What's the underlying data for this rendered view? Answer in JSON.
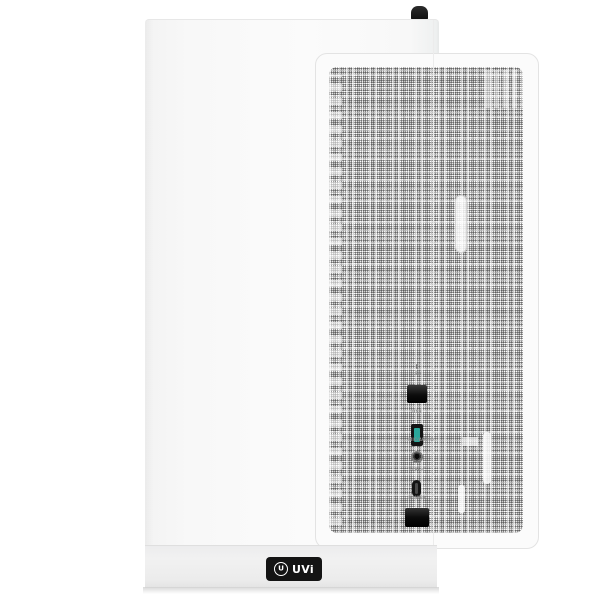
{
  "scene": {
    "type": "product-photo",
    "subject": "White mid-tower PC case, front view with perforated mesh front panel",
    "background_color": "#ffffff",
    "case_color": "#f8f8f8",
    "base_color": "#ececec",
    "mesh_dot_color": "#464646",
    "port_black": "#141414",
    "usb_accent_color": "#2aa79a",
    "label_color": "#8b8b8b"
  },
  "io_panel": {
    "ports": [
      {
        "label": "LED",
        "kind": "button"
      },
      {
        "label": "USB",
        "kind": "usb-a"
      },
      {
        "label": "MIC/AUDIO",
        "kind": "audio-jack"
      },
      {
        "label": "TYPE-C",
        "kind": "usb-c"
      },
      {
        "label": "POWER",
        "kind": "button"
      }
    ]
  },
  "logo": {
    "monogram": "U",
    "text": "UVi"
  }
}
